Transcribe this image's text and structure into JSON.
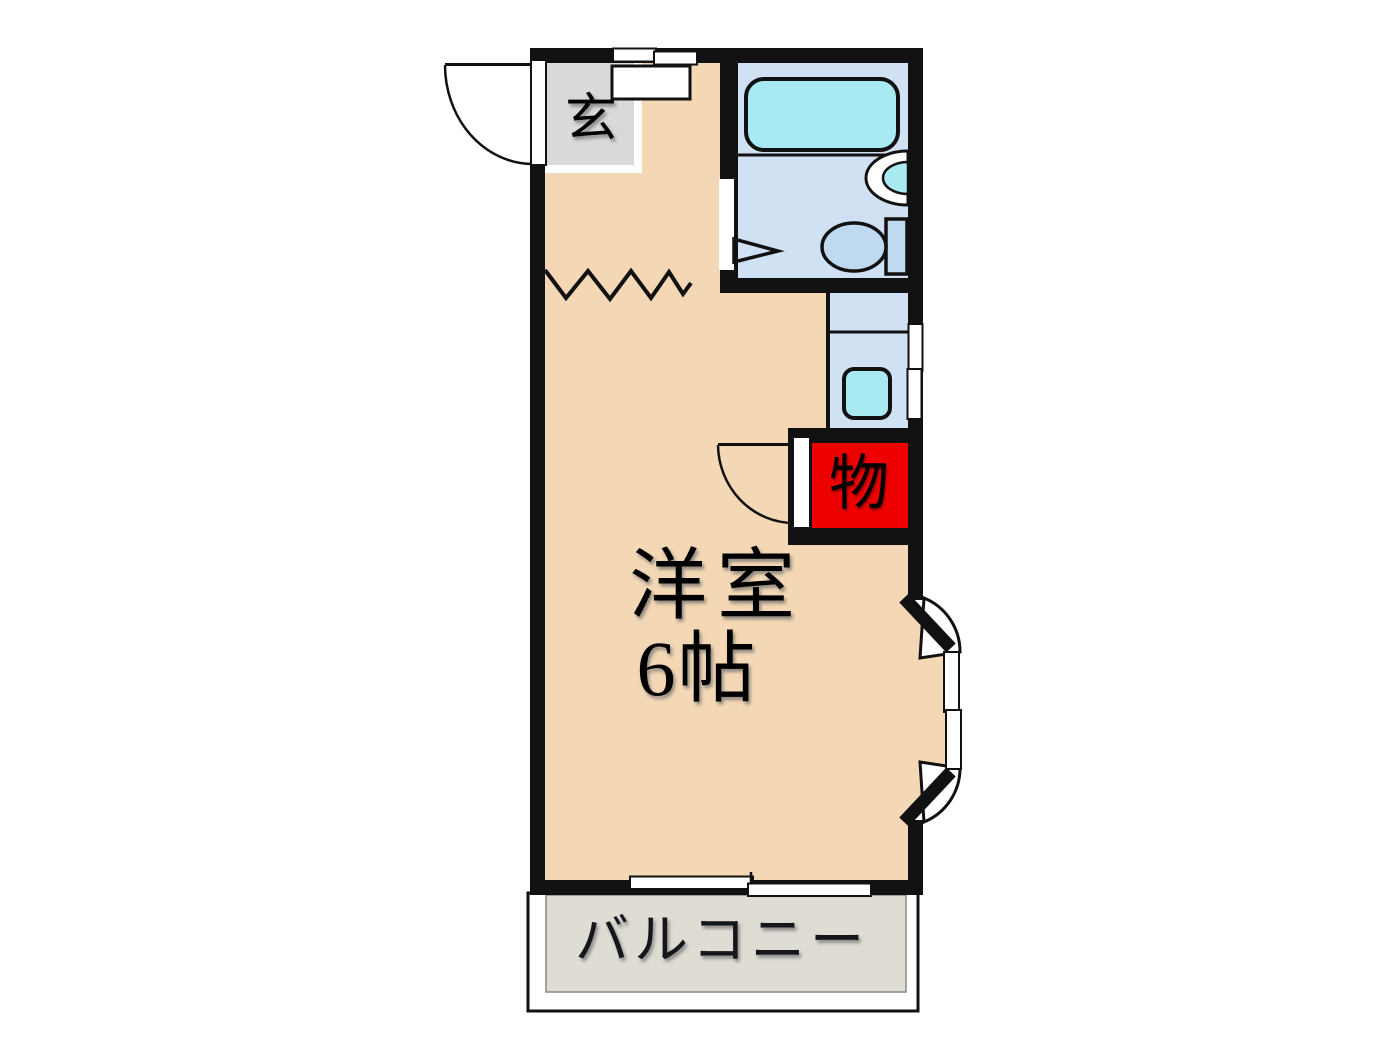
{
  "plan": {
    "entrance": {
      "label": "玄"
    },
    "main_room": {
      "name": "洋室",
      "size": "6帖"
    },
    "closet": {
      "label": "物"
    },
    "balcony": {
      "label": "バルコニー"
    }
  },
  "colors": {
    "wall": "#111111",
    "floor": "#f4d8b5",
    "entrance_tile": "#d9d9d9",
    "bathroom": "#cfe1f3",
    "bathtub": "#a9e9f2",
    "fixture_blue": "#bfd9f1",
    "closet_red": "#ee0000",
    "balcony": "#dfdcd4",
    "line": "#111111"
  }
}
